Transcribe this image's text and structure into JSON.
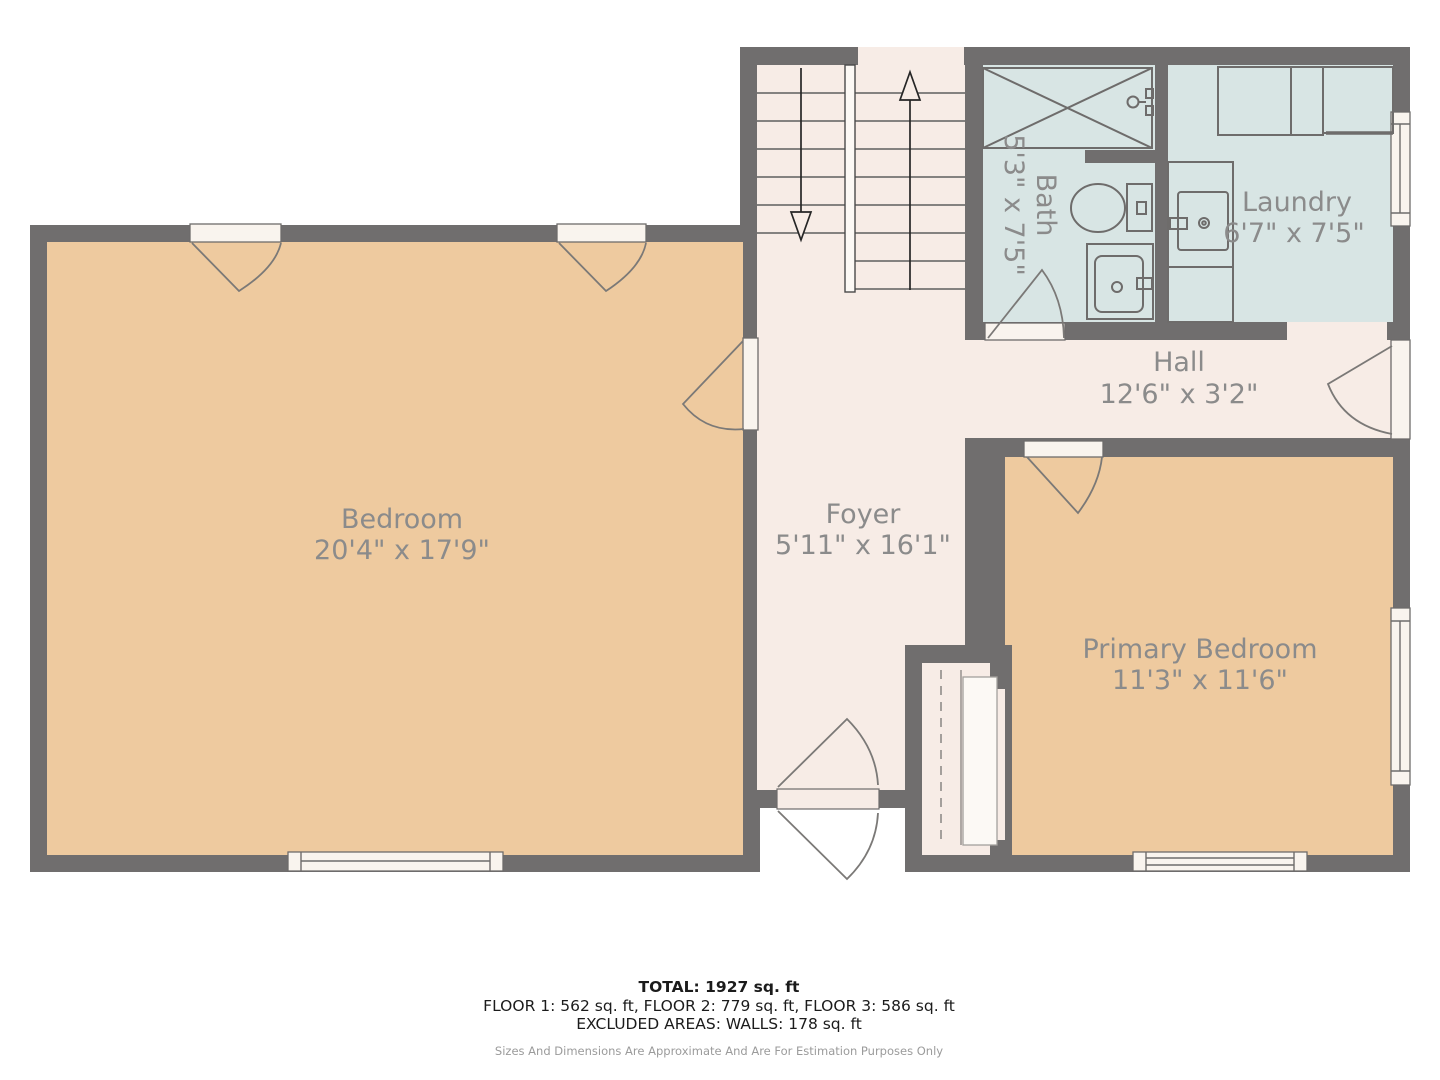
{
  "colors": {
    "wall": "#706e6e",
    "tan": "#eeca9f",
    "cream": "#f7ece6",
    "wet": "#d8e5e4",
    "sill": "#f9f4ee",
    "label": "#8b8b8b",
    "ink": "#1b1b1b",
    "muted": "#9b9b9b"
  },
  "rooms": {
    "bedroom": {
      "name": "Bedroom",
      "dims": "20'4\" x 17'9\""
    },
    "foyer": {
      "name": "Foyer",
      "dims": "5'11\" x 16'1\""
    },
    "hall": {
      "name": "Hall",
      "dims": "12'6\" x 3'2\""
    },
    "bath": {
      "name": "Bath",
      "dims": "5'3\" x 7'5\""
    },
    "laundry": {
      "name": "Laundry",
      "dims": "6'7\" x 7'5\""
    },
    "primary": {
      "name": "Primary Bedroom",
      "dims": "11'3\" x 11'6\""
    }
  },
  "footer": {
    "total": "TOTAL: 1927 sq. ft",
    "floors": "FLOOR 1: 562 sq. ft, FLOOR 2: 779 sq. ft, FLOOR 3: 586 sq. ft",
    "excluded": "EXCLUDED AREAS: WALLS: 178 sq. ft",
    "disclaimer": "Sizes And Dimensions Are Approximate And Are For Estimation Purposes Only"
  }
}
